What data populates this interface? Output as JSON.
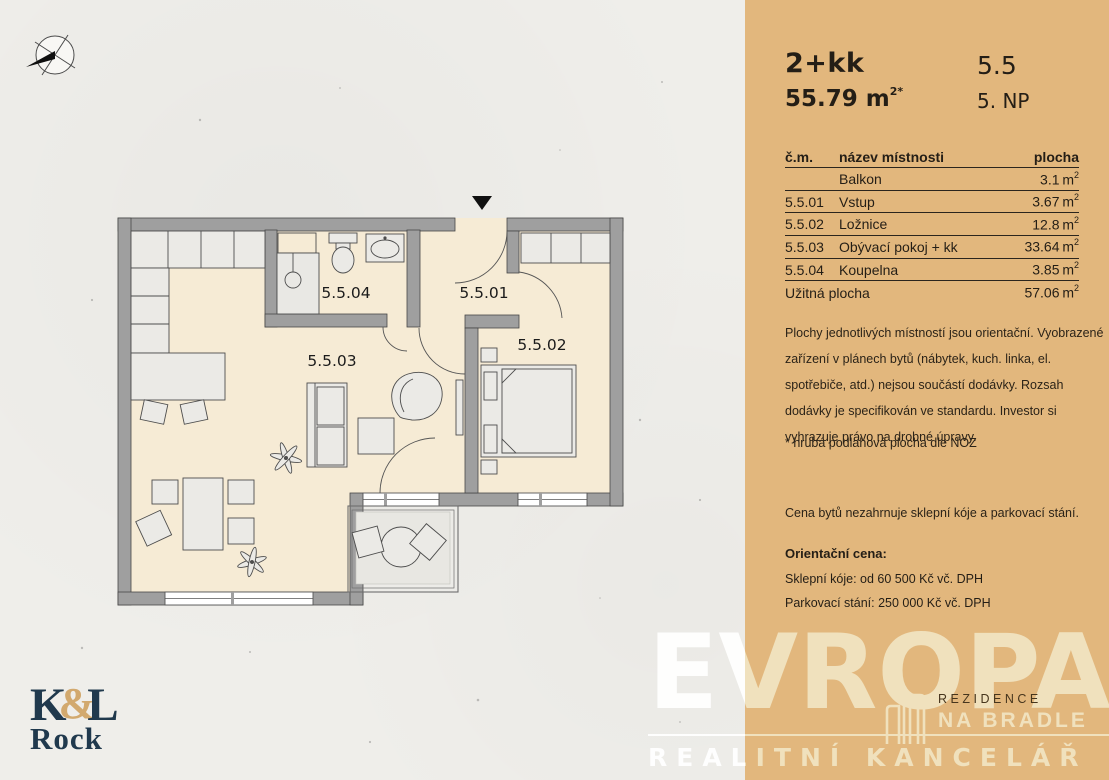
{
  "colors": {
    "panel": "#e2b77d",
    "paper": "#efeeea",
    "wall": "#9f9f9f",
    "floor": "#f6ebd5",
    "ink": "#241e16",
    "cream": "#f0e1bd",
    "navy": "#20394d",
    "gold": "#d2a96e"
  },
  "unit": {
    "layout": "2+kk",
    "number": "5.5",
    "area_value": "55.79 m",
    "area_sup": "2*",
    "floor": "5. NP"
  },
  "table": {
    "headers": {
      "num": "č.m.",
      "name": "název místnosti",
      "area": "plocha"
    },
    "area_unit": "m",
    "area_sup": "2",
    "rows": [
      {
        "num": "",
        "name": "Balkon",
        "area": "3.1"
      },
      {
        "num": "5.5.01",
        "name": "Vstup",
        "area": "3.67"
      },
      {
        "num": "5.5.02",
        "name": "Ložnice",
        "area": "12.8"
      },
      {
        "num": "5.5.03",
        "name": "Obývací pokoj + kk",
        "area": "33.64"
      },
      {
        "num": "5.5.04",
        "name": "Koupelna",
        "area": "3.85"
      }
    ],
    "total": {
      "label": "Užitná plocha",
      "area": "57.06"
    }
  },
  "notes": {
    "disclaimer": "Plochy jednotlivých místností jsou orientační. Vyobrazené zařízení v plánech bytů (nábytek, kuch. linka, el. spotřebiče, atd.) nejsou součástí dodávky. Rozsah dodávky je specifikován ve standardu. Investor si vyhrazuje právo na drobné úpravy.",
    "footnote": "* hrubá podlahová plocha dle NOZ",
    "price_note": "Cena bytů nezahrnuje sklepní kóje a parkovací stání."
  },
  "pricing": {
    "label": "Orientační cena:",
    "lines": [
      "Sklepní kóje: od 60 500 Kč vč. DPH",
      "Parkovací stání: 250 000 Kč vč. DPH"
    ]
  },
  "floorplan": {
    "labels": {
      "entry": "5.5.01",
      "bedroom": "5.5.02",
      "living": "5.5.03",
      "bathroom": "5.5.04"
    }
  },
  "branding": {
    "evropa": "EVROPA",
    "tagline": "REALITNÍ KANCELÁŘ",
    "rezidence": "REZIDENCE",
    "na_bradle": "NA BRADLE",
    "kl_k": "K",
    "kl_amp": "&",
    "kl_l": "L",
    "kl_rock": "Rock"
  }
}
